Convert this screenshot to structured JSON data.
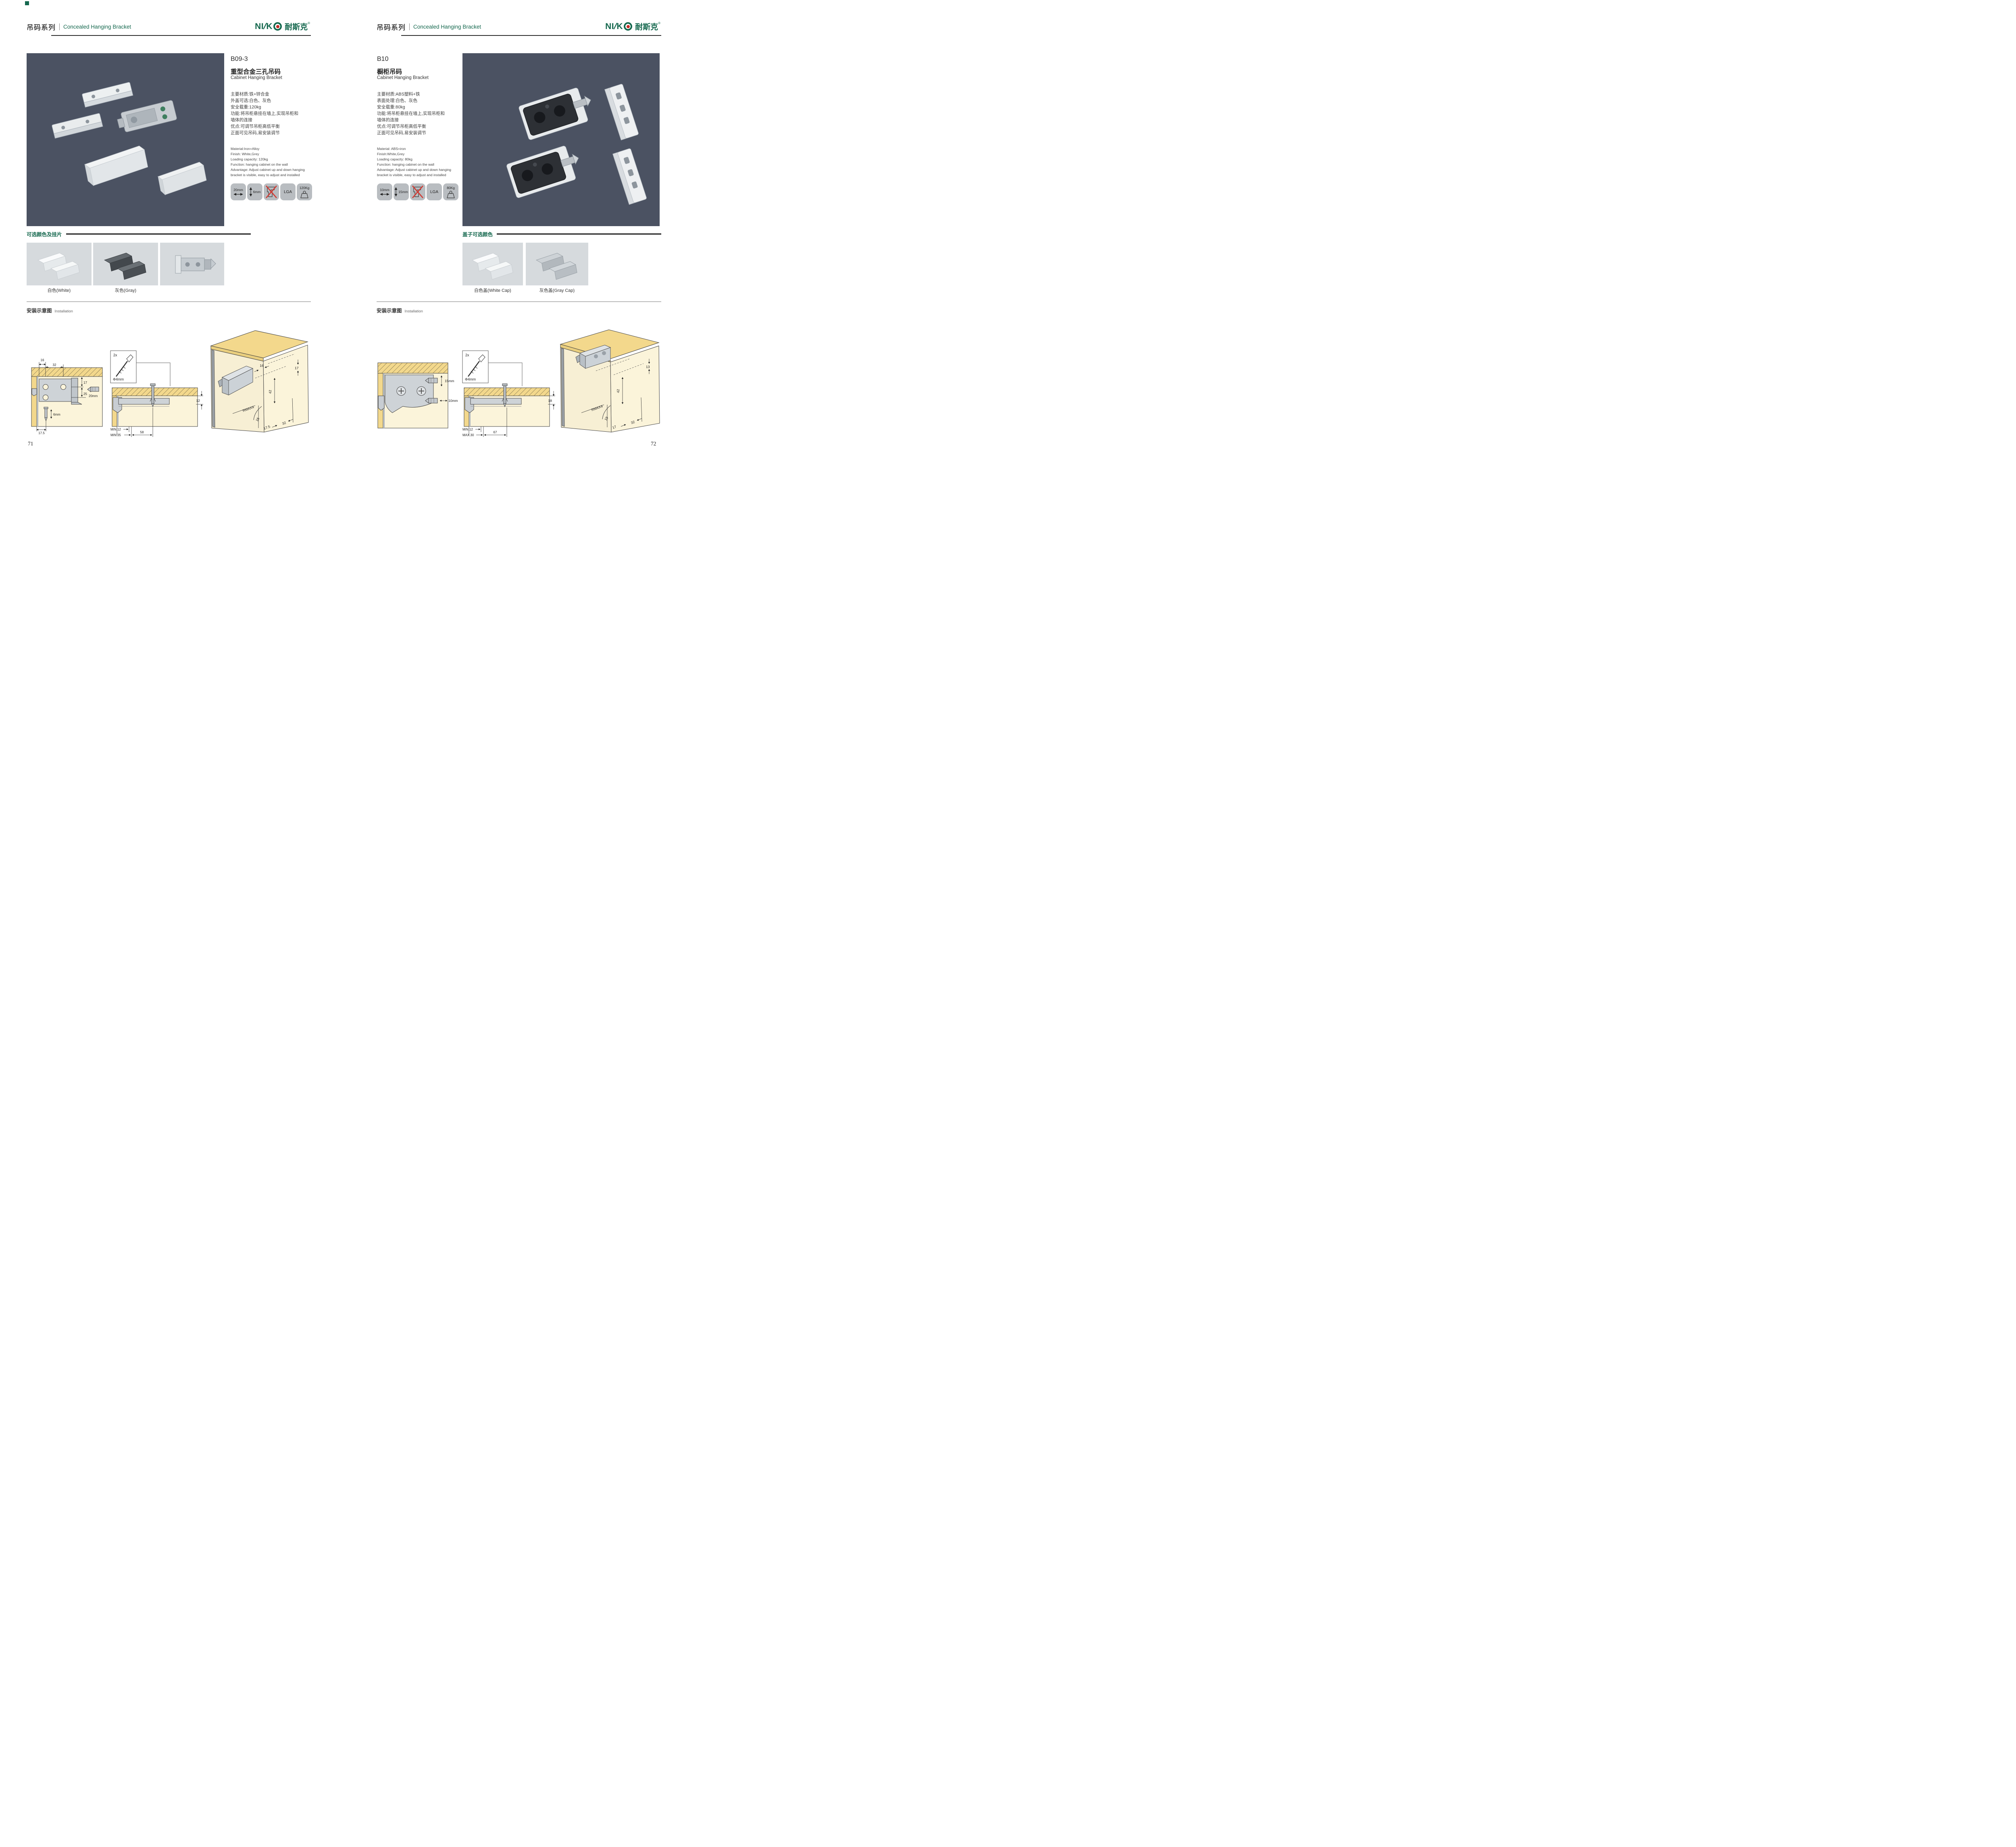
{
  "brand_green": "#15684e",
  "header": {
    "series_cn": "吊码系列",
    "series_en": "Concealed Hanging Bracket"
  },
  "logo": {
    "n": "NI",
    "s": "/",
    "k": "K",
    "cn": "耐斯克",
    "reg": "®"
  },
  "left_page": {
    "page_number": "71",
    "product": {
      "model": "B09-3",
      "name_cn": "重型合金三孔吊码",
      "name_en": "Cabinet Hanging Bracket",
      "specs_cn": [
        "主要材质:铁+锌合金",
        "外盖可选:白色、灰色",
        "安全载重:120kg",
        "功能:将吊柜悬挂在墙上,实现吊柜和",
        "墙体的连接",
        "优点:可调节吊柜高低平衡",
        "正面可见吊码,易安装调节"
      ],
      "specs_en": [
        "Material:Iron+Alloy",
        "Finish: White,Grey",
        "Loading capacity: 120kg",
        "Function: hanging cabinet on the wall",
        "Advantage: Adjust cabinet up and down hanging",
        "bracket is visible, easy to adjust and installed"
      ],
      "badges": {
        "width": "20mm",
        "depth": "6mm",
        "cert": "LGA",
        "load": "120Kg"
      }
    },
    "colors_section": {
      "title": "可选颜色及挂片",
      "labels": [
        "白色(White)",
        "灰色(Gray)"
      ]
    },
    "install": {
      "title_cn": "安装示意图",
      "title_en": "Installation",
      "d1": {
        "a": "16",
        "b": "32",
        "c": "17",
        "d": "25",
        "e": "20mm",
        "f": "6mm",
        "g": "17.5"
      },
      "d2": {
        "qty": "2x",
        "dia": "Φ4mm",
        "h": "12",
        "m1": "MIN.12",
        "m2": "MIN.35",
        "w": "58"
      },
      "d3": {
        "a": "16",
        "b": "17",
        "c": "42",
        "r": "RMAX4",
        "d": "16",
        "e": "17.5",
        "f": "32"
      }
    }
  },
  "right_page": {
    "page_number": "72",
    "product": {
      "model": "B10",
      "name_cn": "橱柜吊码",
      "name_en": "Cabinet Hanging Bracket",
      "specs_cn": [
        "主要材质:ABS塑料+铁",
        "表面处理:白色、灰色",
        "安全载重:80kg",
        "功能:将吊柜悬挂在墙上,实现吊柜和",
        "墙体的连接",
        "优点:可调节吊柜高低平衡",
        "正面可见吊码,易安装调节"
      ],
      "specs_en": [
        "Material: ABS+iron",
        "Finish:White,Grey",
        "Loading capacity: 80kg",
        "Function: hanging cabinet on the wall",
        "Advantage: Adjust cabinet up and down hanging",
        "bracket is visible, easy to adjust and installed"
      ],
      "badges": {
        "width": "10mm",
        "depth": "15mm",
        "cert": "LGA",
        "load": "80Kg"
      }
    },
    "colors_section": {
      "title": "盖子可选颜色",
      "labels": [
        "白色盖(White Cap)",
        "灰色盖(Gray Cap)"
      ]
    },
    "install": {
      "title_cn": "安装示意图",
      "title_en": "Installation",
      "d1": {
        "v": "15mm",
        "h": "10mm"
      },
      "d2": {
        "qty": "2x",
        "dia": "Φ4mm",
        "h": "18",
        "m1": "MIN.12",
        "m2": "MAX.30",
        "w": "67"
      },
      "d3": {
        "a": "13",
        "c": "42",
        "r": "RMAX4",
        "d": "19",
        "e": "17",
        "f": "32"
      }
    }
  }
}
